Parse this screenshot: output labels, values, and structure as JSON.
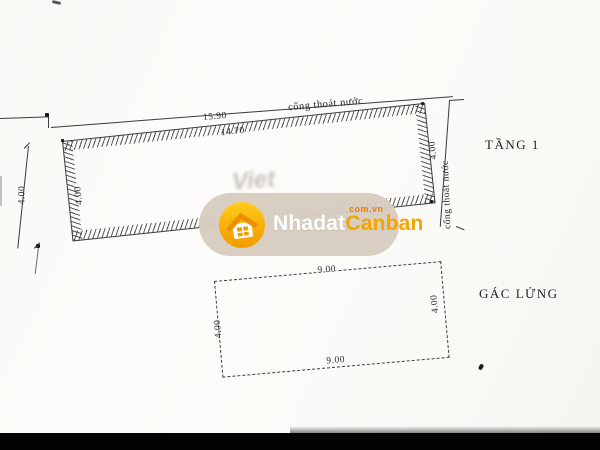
{
  "plan": {
    "floor1": {
      "label": "TẦNG 1",
      "top_drain_note": "cống thoát nước",
      "right_drain_note": "cống thoát nước",
      "dim_frontage_outer": "15.90",
      "dim_frontage_inner": "14.70",
      "dim_left_outer": "4.00",
      "dim_left_inner": "4.00",
      "dim_right": "4.00"
    },
    "mezzanine": {
      "label": "GÁC LỬNG",
      "dim_top": "9.00",
      "dim_bottom": "9.00",
      "dim_left": "4.00",
      "dim_right": "4.00"
    }
  },
  "watermark": {
    "brand_first": "Nhadat",
    "brand_second": "Canban",
    "domain_suffix": "com.vn",
    "colors": {
      "pill_bg": "#D7CCBF",
      "circle_top": "#FFCD1E",
      "circle_bottom": "#F29D00",
      "brand_orange": "#F7A300",
      "suffix_orange": "#EE7C00",
      "brand_white": "#FFFFFF"
    }
  },
  "scan": {
    "faint_text": "Viet",
    "ink_color": "#3A3A3A",
    "paper_color": "#FCFBF8",
    "bottom_bar_color": "#030303"
  }
}
